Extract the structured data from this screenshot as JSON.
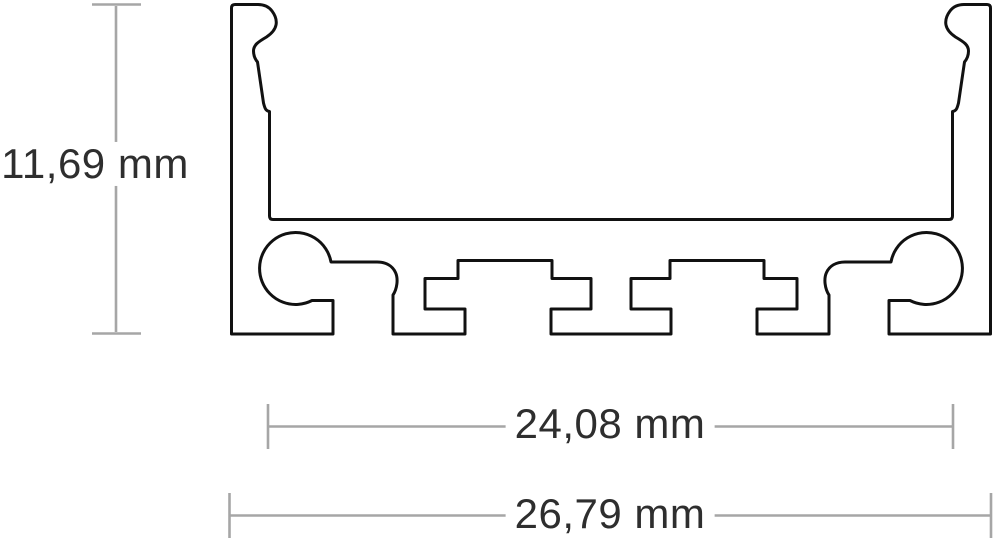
{
  "diagram": {
    "type": "profile-cross-section",
    "dimensions": {
      "height": "11,69 mm",
      "inner_width": "24,08 mm",
      "outer_width": "26,79 mm"
    },
    "colors": {
      "outline": "#111111",
      "dimension_line": "#a6a6a6",
      "label_text": "#2e2e2e",
      "background": "#ffffff"
    }
  }
}
